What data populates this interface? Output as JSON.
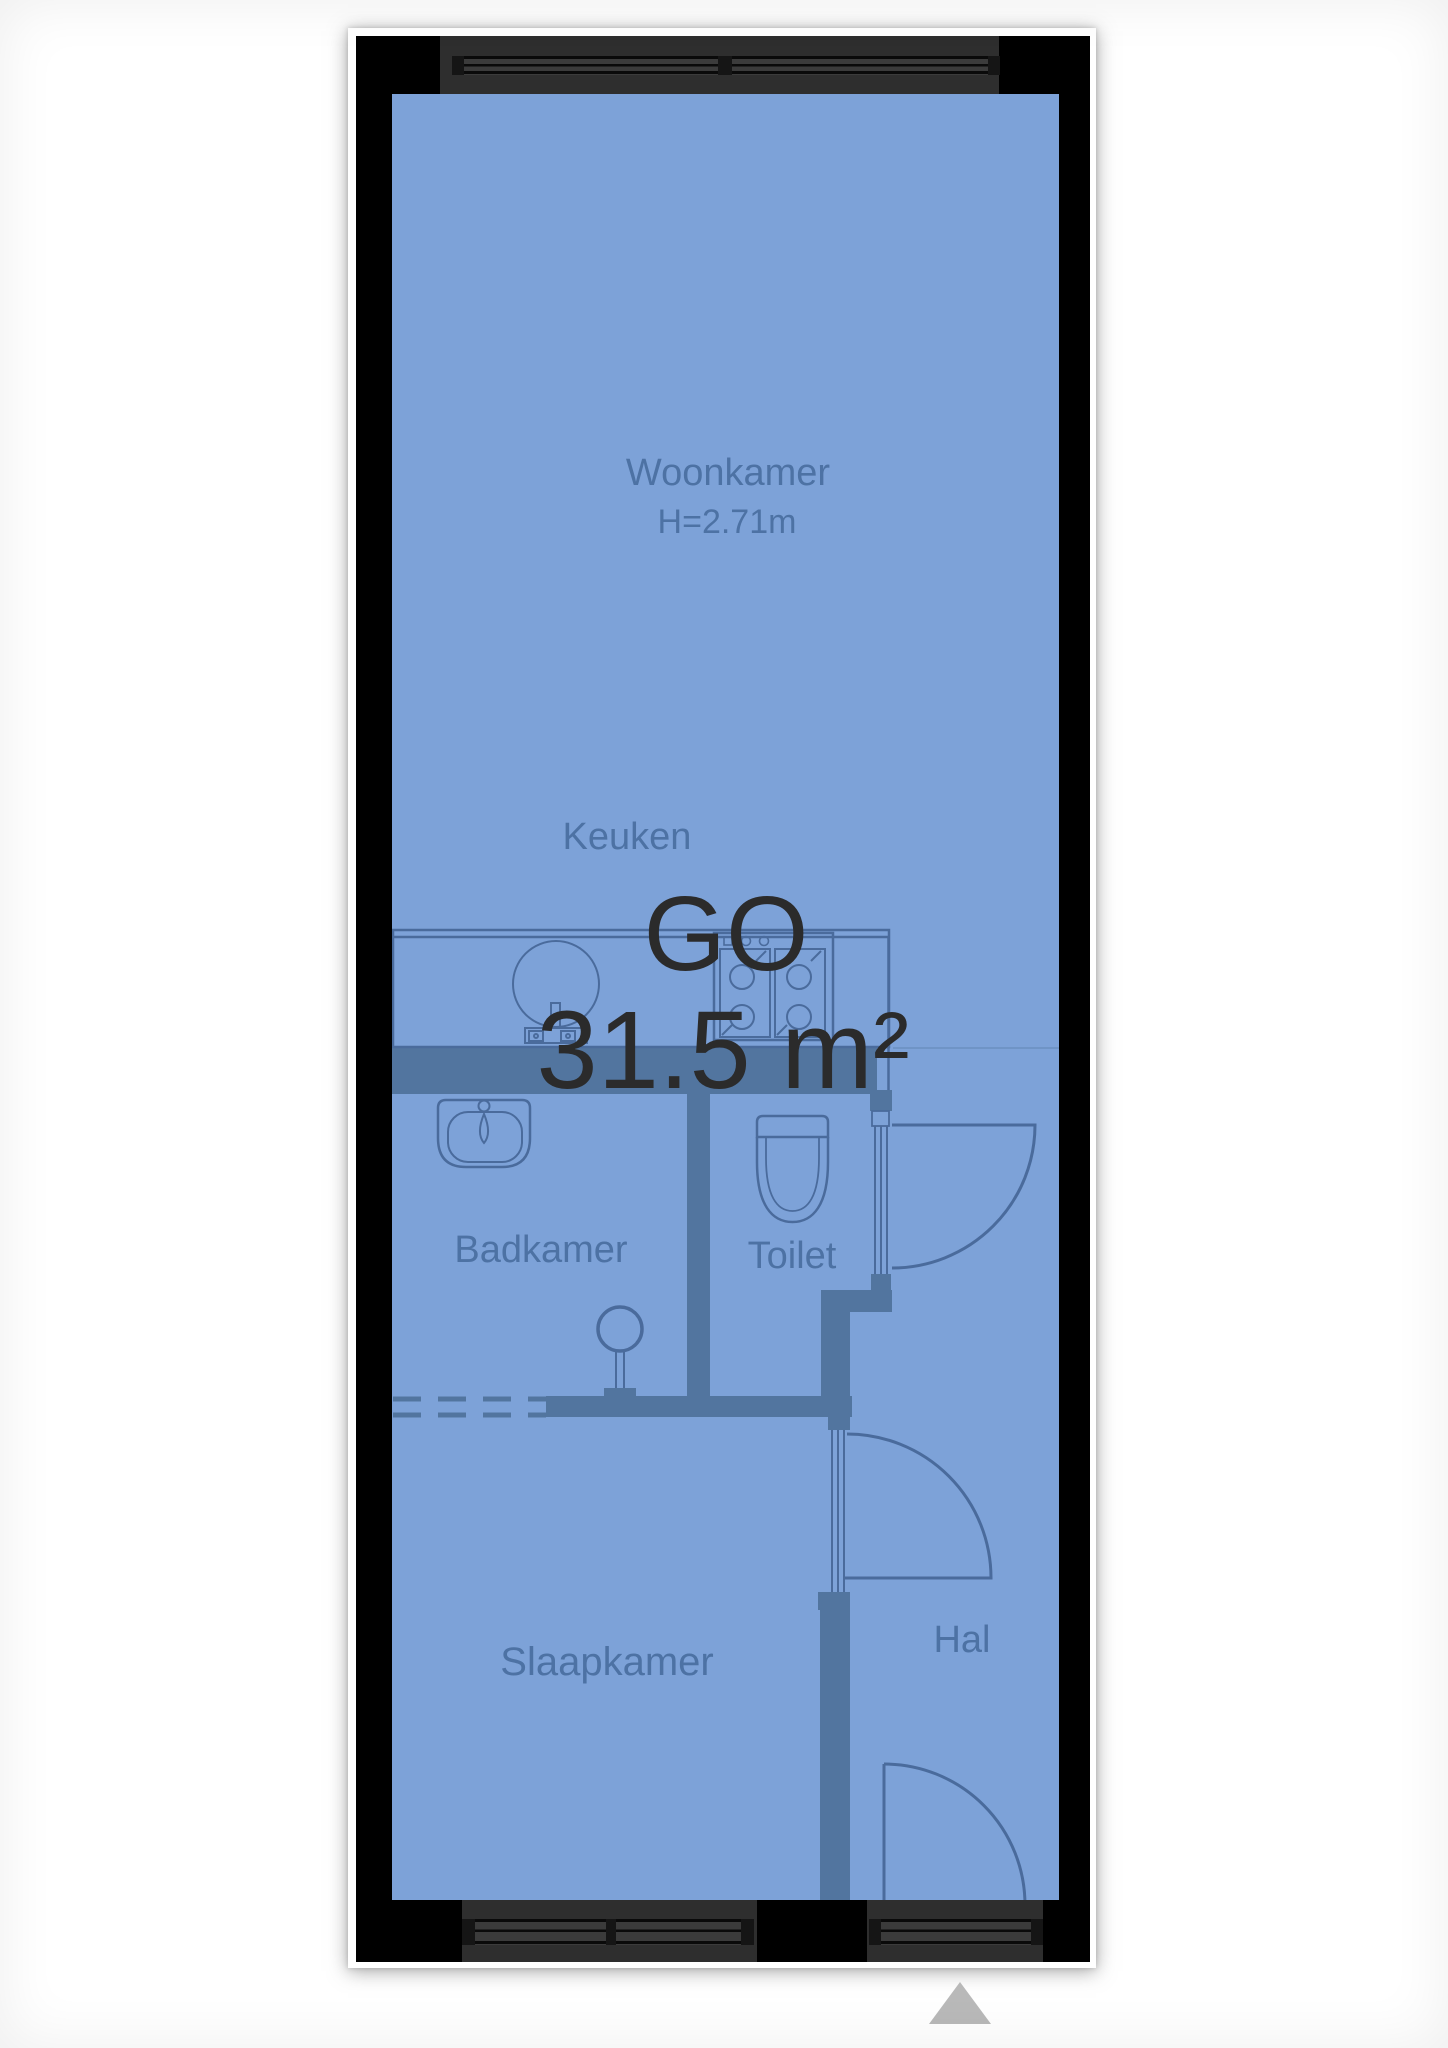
{
  "floorplan": {
    "area_label": "GO",
    "area_value": "31.5 m²",
    "rooms": {
      "woonkamer": {
        "label": "Woonkamer",
        "height_note": "H=2.71m"
      },
      "keuken": {
        "label": "Keuken"
      },
      "badkamer": {
        "label": "Badkamer"
      },
      "toilet": {
        "label": "Toilet"
      },
      "slaapkamer": {
        "label": "Slaapkamer"
      },
      "hal": {
        "label": "Hal"
      }
    },
    "colors": {
      "floor_overlay": "#7da2d8",
      "partition_wall": "#52759f",
      "fixture_line": "#4a6b9c",
      "outer_wall": "#000000",
      "window_band": "#2e2e2e",
      "window_inset": "#3b3b3b",
      "area_text": "#2b2b2b",
      "room_text": "#4d72a4",
      "north_arrow": "#b9b9b9"
    }
  }
}
